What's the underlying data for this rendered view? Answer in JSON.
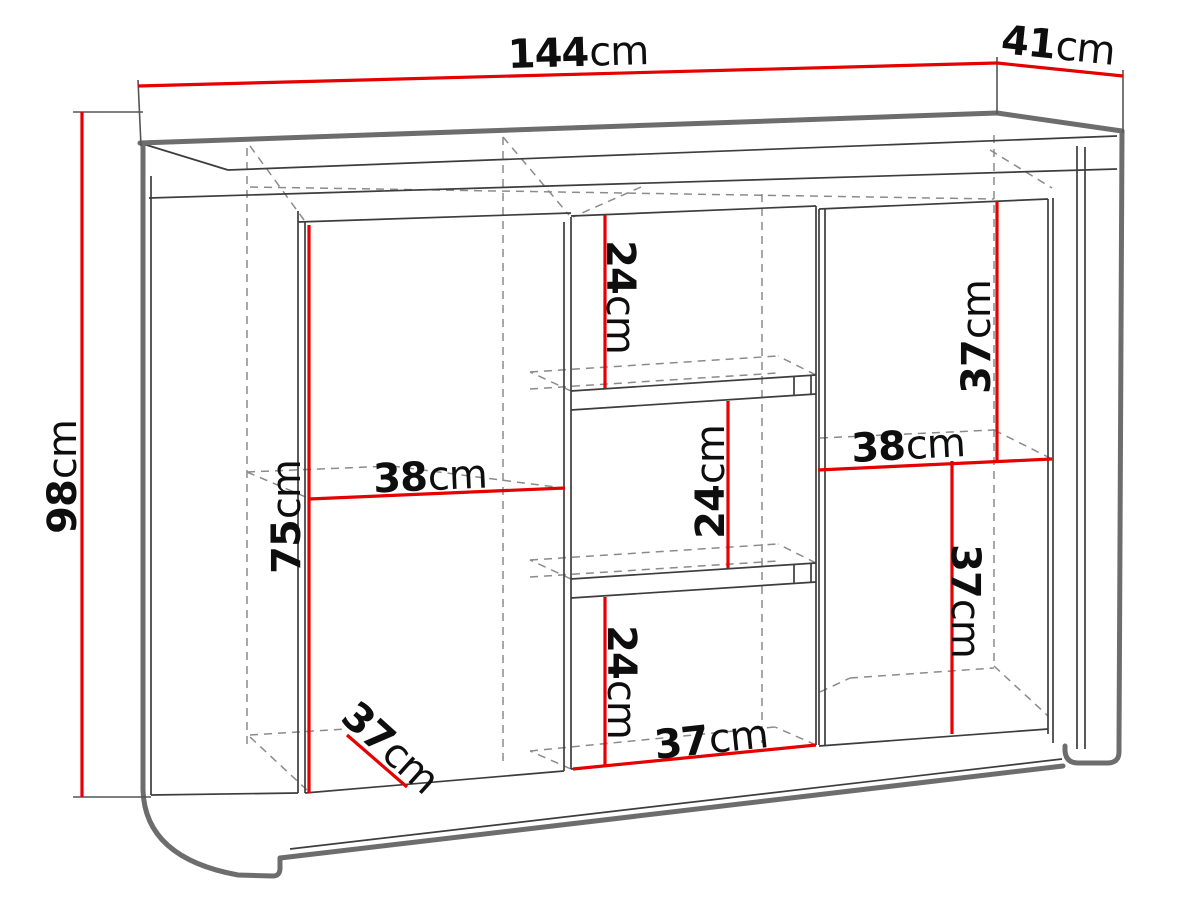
{
  "diagram_type": "furniture-dimension-drawing",
  "unit": "cm",
  "dimensions": {
    "overall_width": {
      "value": "144",
      "unit": "cm"
    },
    "overall_depth": {
      "value": "41",
      "unit": "cm"
    },
    "overall_height": {
      "value": "98",
      "unit": "cm"
    },
    "left_compartment_width": {
      "value": "38",
      "unit": "cm"
    },
    "left_door_inner_height": {
      "value": "75",
      "unit": "cm"
    },
    "left_compartment_depth": {
      "value": "37",
      "unit": "cm"
    },
    "center_top_compartment_height": {
      "value": "24",
      "unit": "cm"
    },
    "center_niche_height": {
      "value": "24",
      "unit": "cm"
    },
    "center_bottom_compartment_height": {
      "value": "24",
      "unit": "cm"
    },
    "center_compartment_width": {
      "value": "37",
      "unit": "cm"
    },
    "right_upper_compartment_height": {
      "value": "37",
      "unit": "cm"
    },
    "right_compartment_width": {
      "value": "38",
      "unit": "cm"
    },
    "right_lower_compartment_height": {
      "value": "37",
      "unit": "cm"
    }
  },
  "colors": {
    "dimension_red": "#e60000",
    "outline_gray": "#6d6d6d",
    "hidden_gray": "#8b8b8b",
    "line_dark": "#3d3d3d",
    "label_black": "#0e0e0e"
  }
}
